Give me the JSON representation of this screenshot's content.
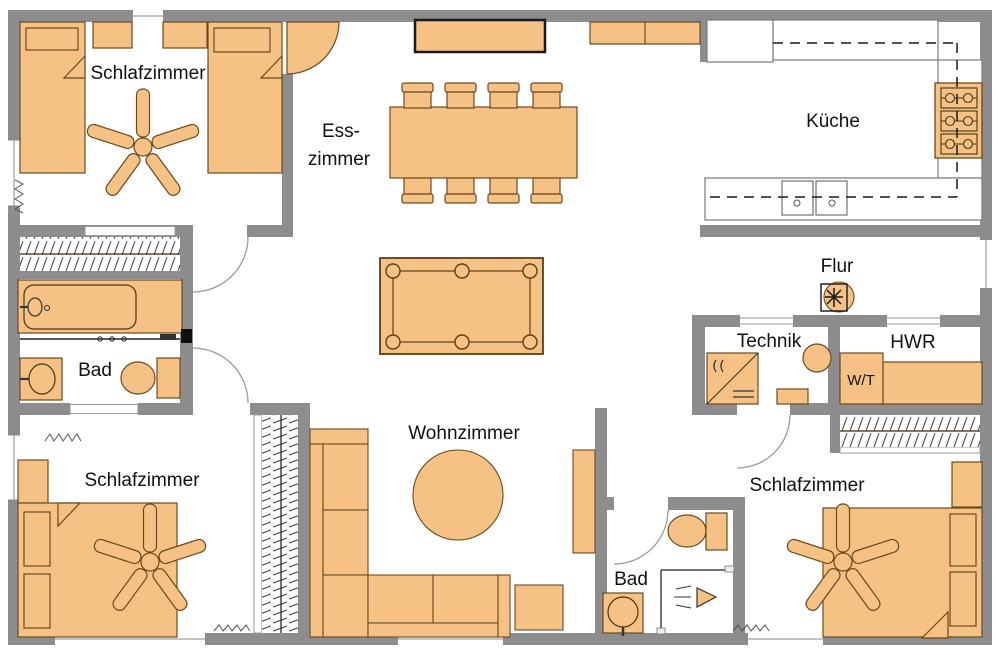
{
  "plan": {
    "type": "apartment-floor-plan",
    "canvas_width": 1000,
    "canvas_height": 655
  },
  "colors": {
    "wall": "#8d8d8d",
    "furniture_fill": "#f5c185",
    "furniture_stroke": "#6b4a1d",
    "counter_stroke": "#7a7a7a",
    "dashed_line": "#1a1a1a",
    "text": "#111111",
    "background": "#ffffff"
  },
  "rooms": {
    "bedroom_top_left": {
      "label": "Schlafzimmer"
    },
    "dining_room": {
      "line1": "Ess-",
      "line2": "zimmer"
    },
    "kitchen": {
      "label": "Küche"
    },
    "hall": {
      "label": "Flur"
    },
    "tech_room": {
      "label": "Technik"
    },
    "utility_room": {
      "label": "HWR"
    },
    "bath_left": {
      "label": "Bad"
    },
    "bedroom_bottom_left": {
      "label": "Schlafzimmer"
    },
    "living_room": {
      "label": "Wohnzimmer"
    },
    "bath_bottom": {
      "label": "Bad"
    },
    "bedroom_bottom_right": {
      "label": "Schlafzimmer"
    }
  },
  "appliances": {
    "washer_dryer": {
      "label": "W/T"
    }
  },
  "furniture_legend": [
    "single-bed",
    "double-bed",
    "pillow",
    "nightstand",
    "ceiling-fan",
    "sideboard",
    "dining-table",
    "dining-chair",
    "billiard-table",
    "corner-sofa",
    "coffee-table",
    "side-table",
    "tv-board",
    "wardrobe-with-clothes",
    "sliding-door",
    "bathtub",
    "washbasin",
    "toilet",
    "shower",
    "towel-rail",
    "kitchen-counter",
    "tall-cabinet",
    "stove",
    "kitchen-sink",
    "upper-cabinet-dashed",
    "washer-dryer-tower",
    "utility-counter",
    "heat-pump",
    "boiler",
    "plant",
    "door-swing",
    "window",
    "ventilation-mark"
  ]
}
